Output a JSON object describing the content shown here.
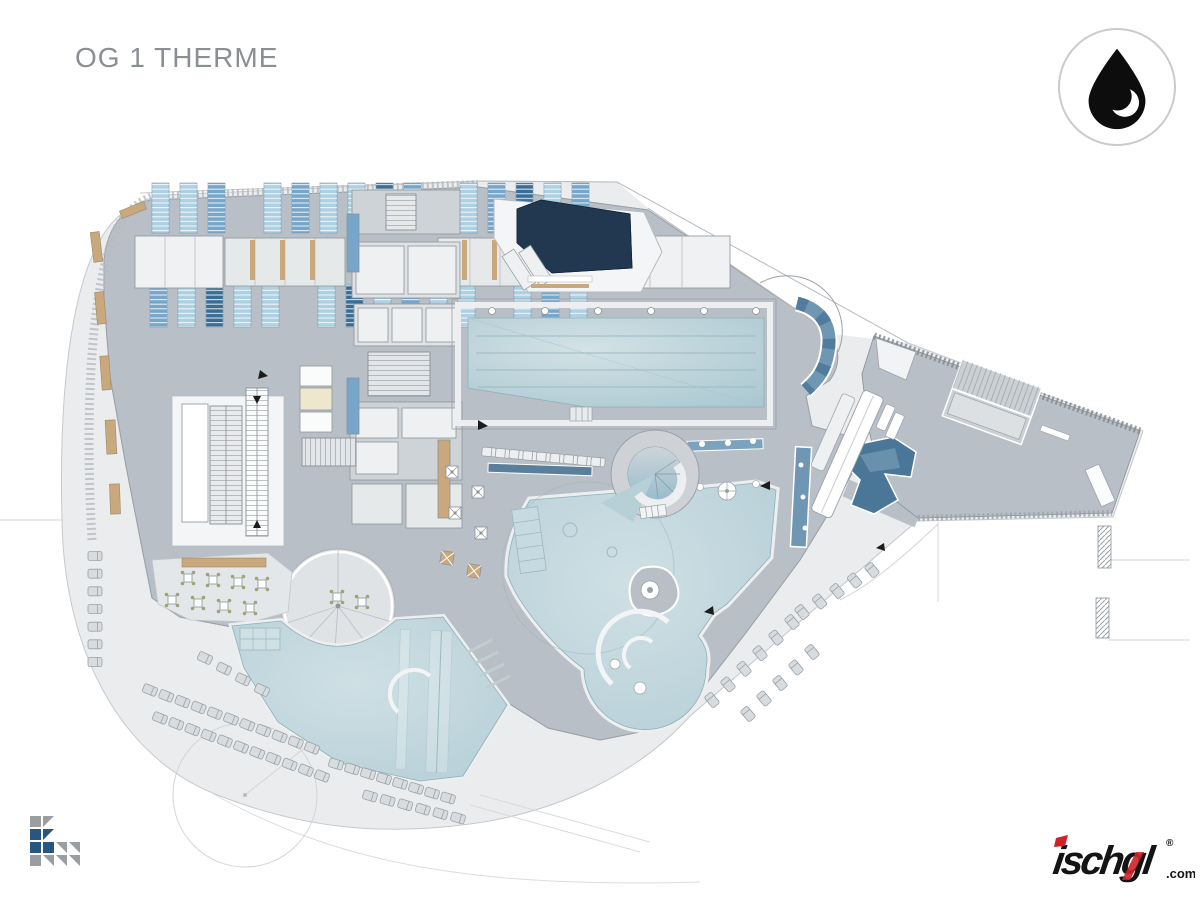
{
  "header": {
    "title": "OG 1 THERME"
  },
  "branding": {
    "drop_badge": {
      "icon": "water-drop-icon"
    },
    "footer_logo_left": {
      "icon": "pixel-k-logo-icon"
    },
    "footer_logo_right": {
      "wordmark": "ischgl",
      "registered_mark": "®",
      "domain_suffix": ".com"
    }
  },
  "colors": {
    "page": "#ffffff",
    "title": "#8a8f93",
    "ground": "#eaecee",
    "ground_line": "#c6c9cc",
    "deck": "#b9bfc6",
    "deck_light": "#e0e3e6",
    "room": "#ced3d7",
    "white_room": "#f4f5f6",
    "water": "#b7d0d7",
    "water_light": "#d3e2e6",
    "navy": "#223750",
    "tile_blue": "#6f96b2",
    "tile_dark": "#4a7698",
    "locker_light": "#aed0e3",
    "locker_mid": "#76a6c9",
    "locker_dark": "#3a6d96",
    "wood": "#c8a87c",
    "olive": "#a2a276",
    "stroke": "#8d949a",
    "accent_red": "#cf2127",
    "ink": "#141414"
  }
}
